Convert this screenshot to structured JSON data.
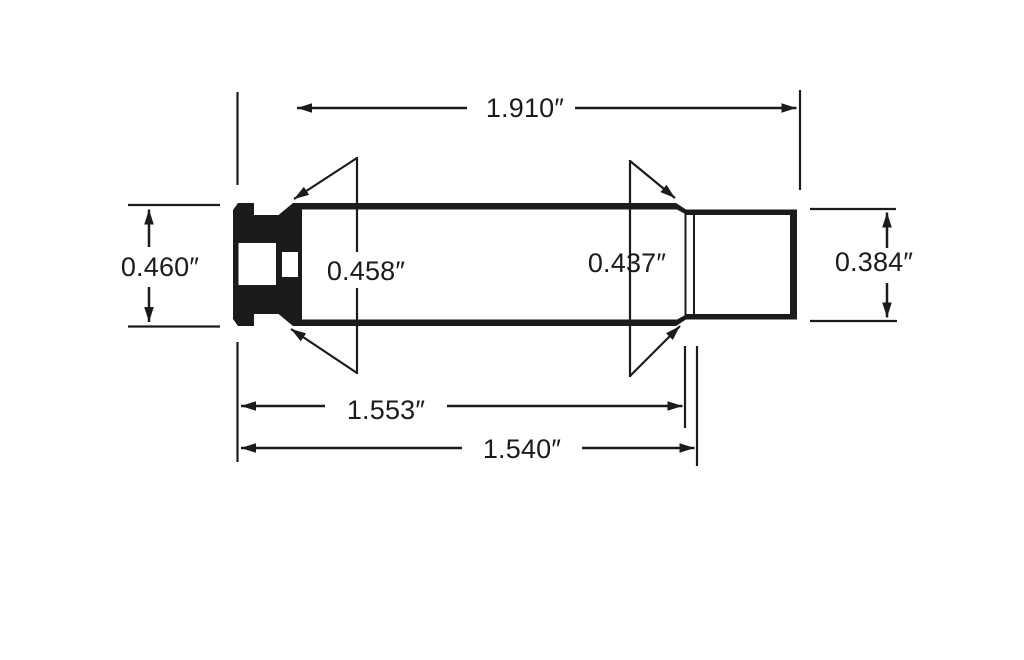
{
  "colors": {
    "ink": "#1b1b1b",
    "background": "#ffffff"
  },
  "diagram": {
    "labels": {
      "overall_length": "1.910″",
      "rim_diameter": "0.460″",
      "base_diameter": "0.458″",
      "shoulder_diameter": "0.437″",
      "neck_diameter": "0.384″",
      "length_to_shoulder": "1.553″",
      "case_length": "1.540″"
    }
  }
}
